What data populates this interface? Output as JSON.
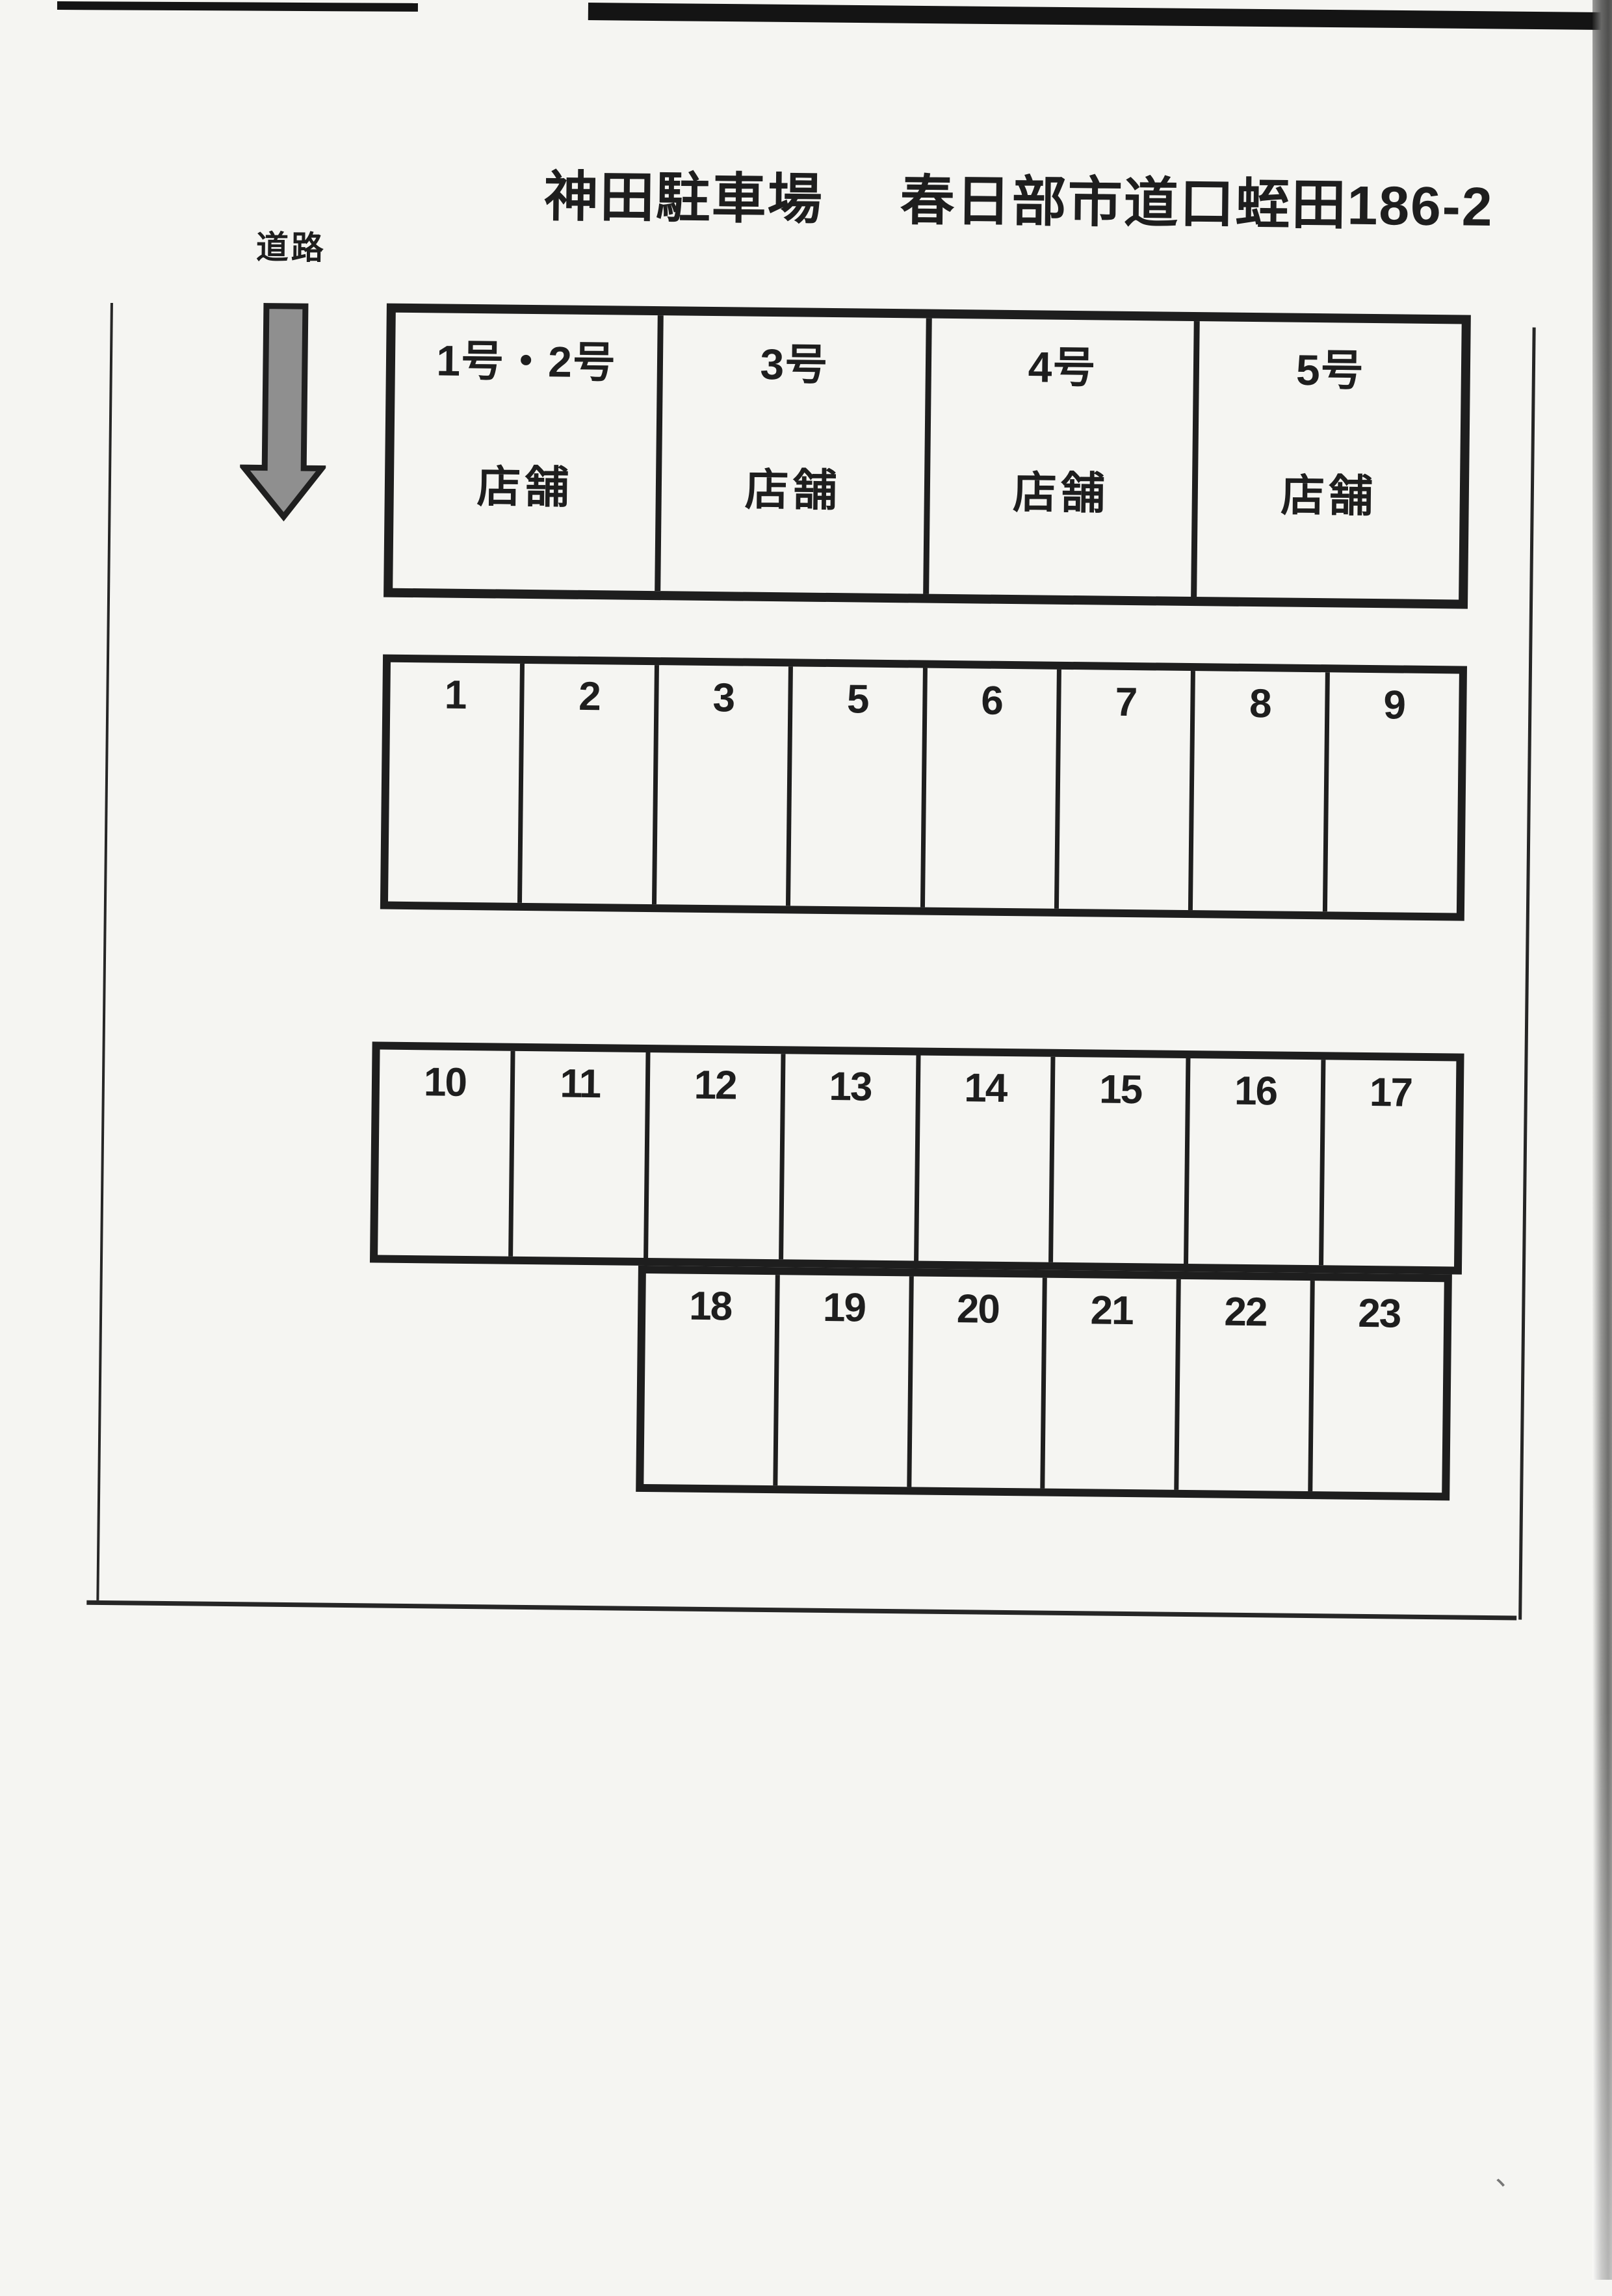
{
  "header": {
    "title_name": "神田駐車場",
    "title_address": "春日部市道口蛭田186-2"
  },
  "road": {
    "label": "道路"
  },
  "shops": {
    "units": [
      {
        "unit": "1号・2号",
        "label": "店舗"
      },
      {
        "unit": "3号",
        "label": "店舗"
      },
      {
        "unit": "4号",
        "label": "店舗"
      },
      {
        "unit": "5号",
        "label": "店舗"
      }
    ]
  },
  "parking": {
    "row_a": [
      "1",
      "2",
      "3",
      "5",
      "6",
      "7",
      "8",
      "9"
    ],
    "row_b": [
      "10",
      "11",
      "12",
      "13",
      "14",
      "15",
      "16",
      "17"
    ],
    "row_c": [
      "18",
      "19",
      "20",
      "21",
      "22",
      "23"
    ]
  },
  "artifacts": {
    "corner_mark": "、"
  },
  "colors": {
    "line": "#1e1e1e",
    "paper": "#f5f5f2",
    "arrow-fill": "#8f8f8f",
    "arrow-stroke": "#1f1f1f"
  }
}
